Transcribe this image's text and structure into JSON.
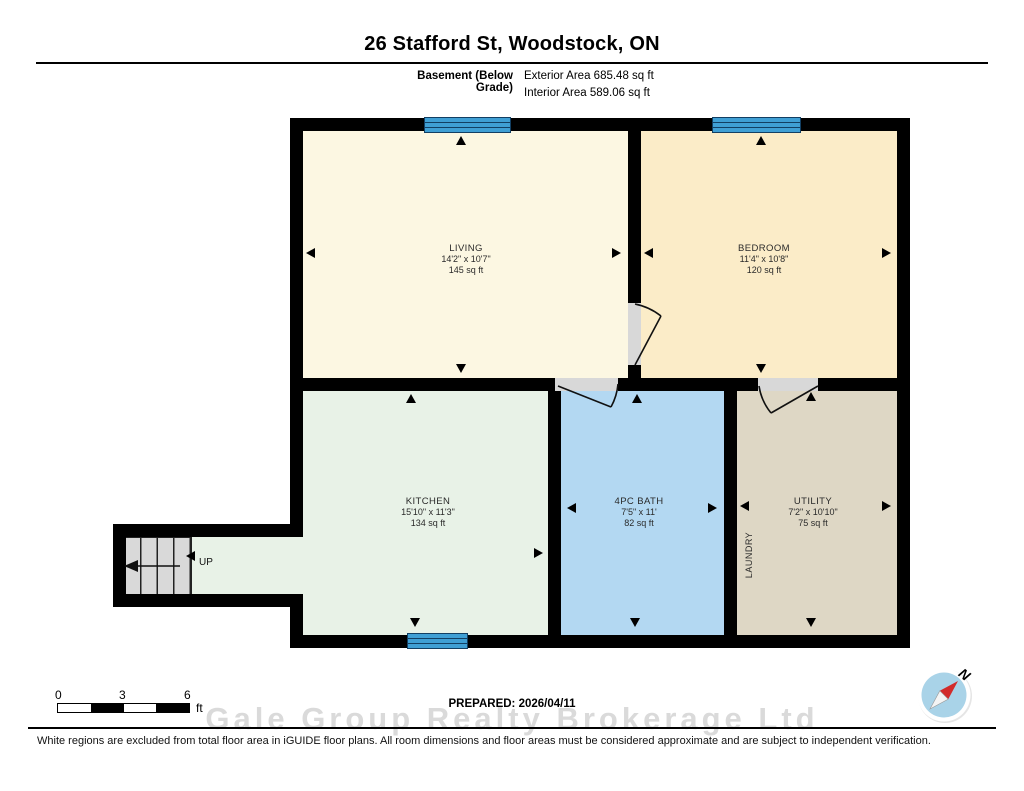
{
  "header": {
    "title": "26 Stafford St, Woodstock, ON",
    "floor_label": "Basement (Below Grade)",
    "exterior_area": "Exterior Area 685.48 sq ft",
    "interior_area": "Interior Area 589.06 sq ft"
  },
  "rooms": [
    {
      "name": "LIVING",
      "dimensions": "14'2\" x 10'7\"",
      "area": "145 sq ft"
    },
    {
      "name": "BEDROOM",
      "dimensions": "11'4\" x 10'8\"",
      "area": "120 sq ft"
    },
    {
      "name": "KITCHEN",
      "dimensions": "15'10\" x 11'3\"",
      "area": "134 sq ft"
    },
    {
      "name": "4PC BATH",
      "dimensions": "7'5\" x 11'",
      "area": "82 sq ft"
    },
    {
      "name": "UTILITY",
      "dimensions": "7'2\" x 10'10\"",
      "area": "75 sq ft"
    }
  ],
  "labels": {
    "laundry": "LAUNDRY",
    "up": "UP",
    "north": "N"
  },
  "scale_bar": {
    "ticks": [
      "0",
      "3",
      "6"
    ],
    "unit": "ft"
  },
  "footer": {
    "prepared": "PREPARED: 2026/04/11",
    "watermark": "Gale Group Realty Brokerage Ltd",
    "disclaimer": "White regions are excluded from total floor area in iGUIDE floor plans. All room dimensions and floor areas must be considered approximate and are subject to independent verification."
  },
  "colors": {
    "living": "#fcf7e2",
    "bedroom": "#fbecc8",
    "kitchen": "#e8f2e7",
    "bath": "#b3d8f2",
    "utility": "#ded7c5",
    "window": "#3f9fd4",
    "wall": "#000000",
    "compass": "#a9d3e8",
    "needle": "#d22b2b"
  }
}
